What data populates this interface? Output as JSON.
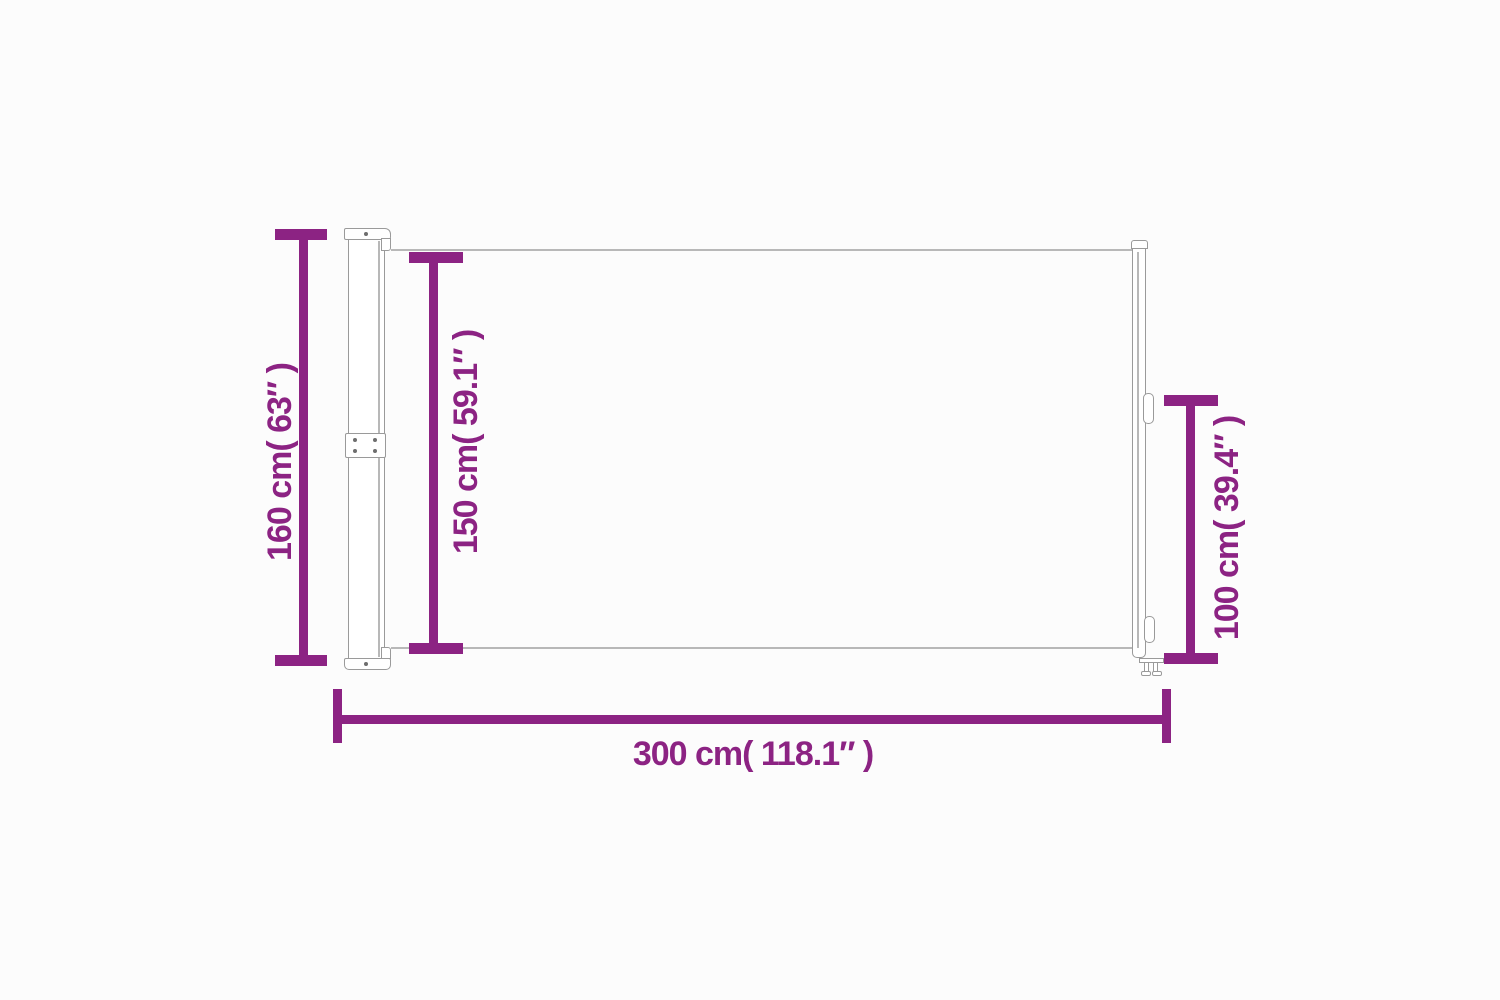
{
  "page": {
    "background": "#fcfcfc"
  },
  "diagram": {
    "colors": {
      "accent": "#8C2383",
      "outline": "#9a9a9a",
      "outline_light": "#b8b8b8",
      "screw": "#6e6e6e",
      "surface": "#ffffff"
    },
    "dimensions": {
      "total_height": {
        "label": "160 cm( 63″ )",
        "cm": 160,
        "inch": 63
      },
      "fabric_height": {
        "label": "150 cm( 59.1″ )",
        "cm": 150,
        "inch": 59.1
      },
      "pole_height": {
        "label": "100 cm( 39.4″ )",
        "cm": 100,
        "inch": 39.4
      },
      "total_width": {
        "label": "300 cm( 118.1″ )",
        "cm": 300,
        "inch": 118.1
      }
    }
  }
}
